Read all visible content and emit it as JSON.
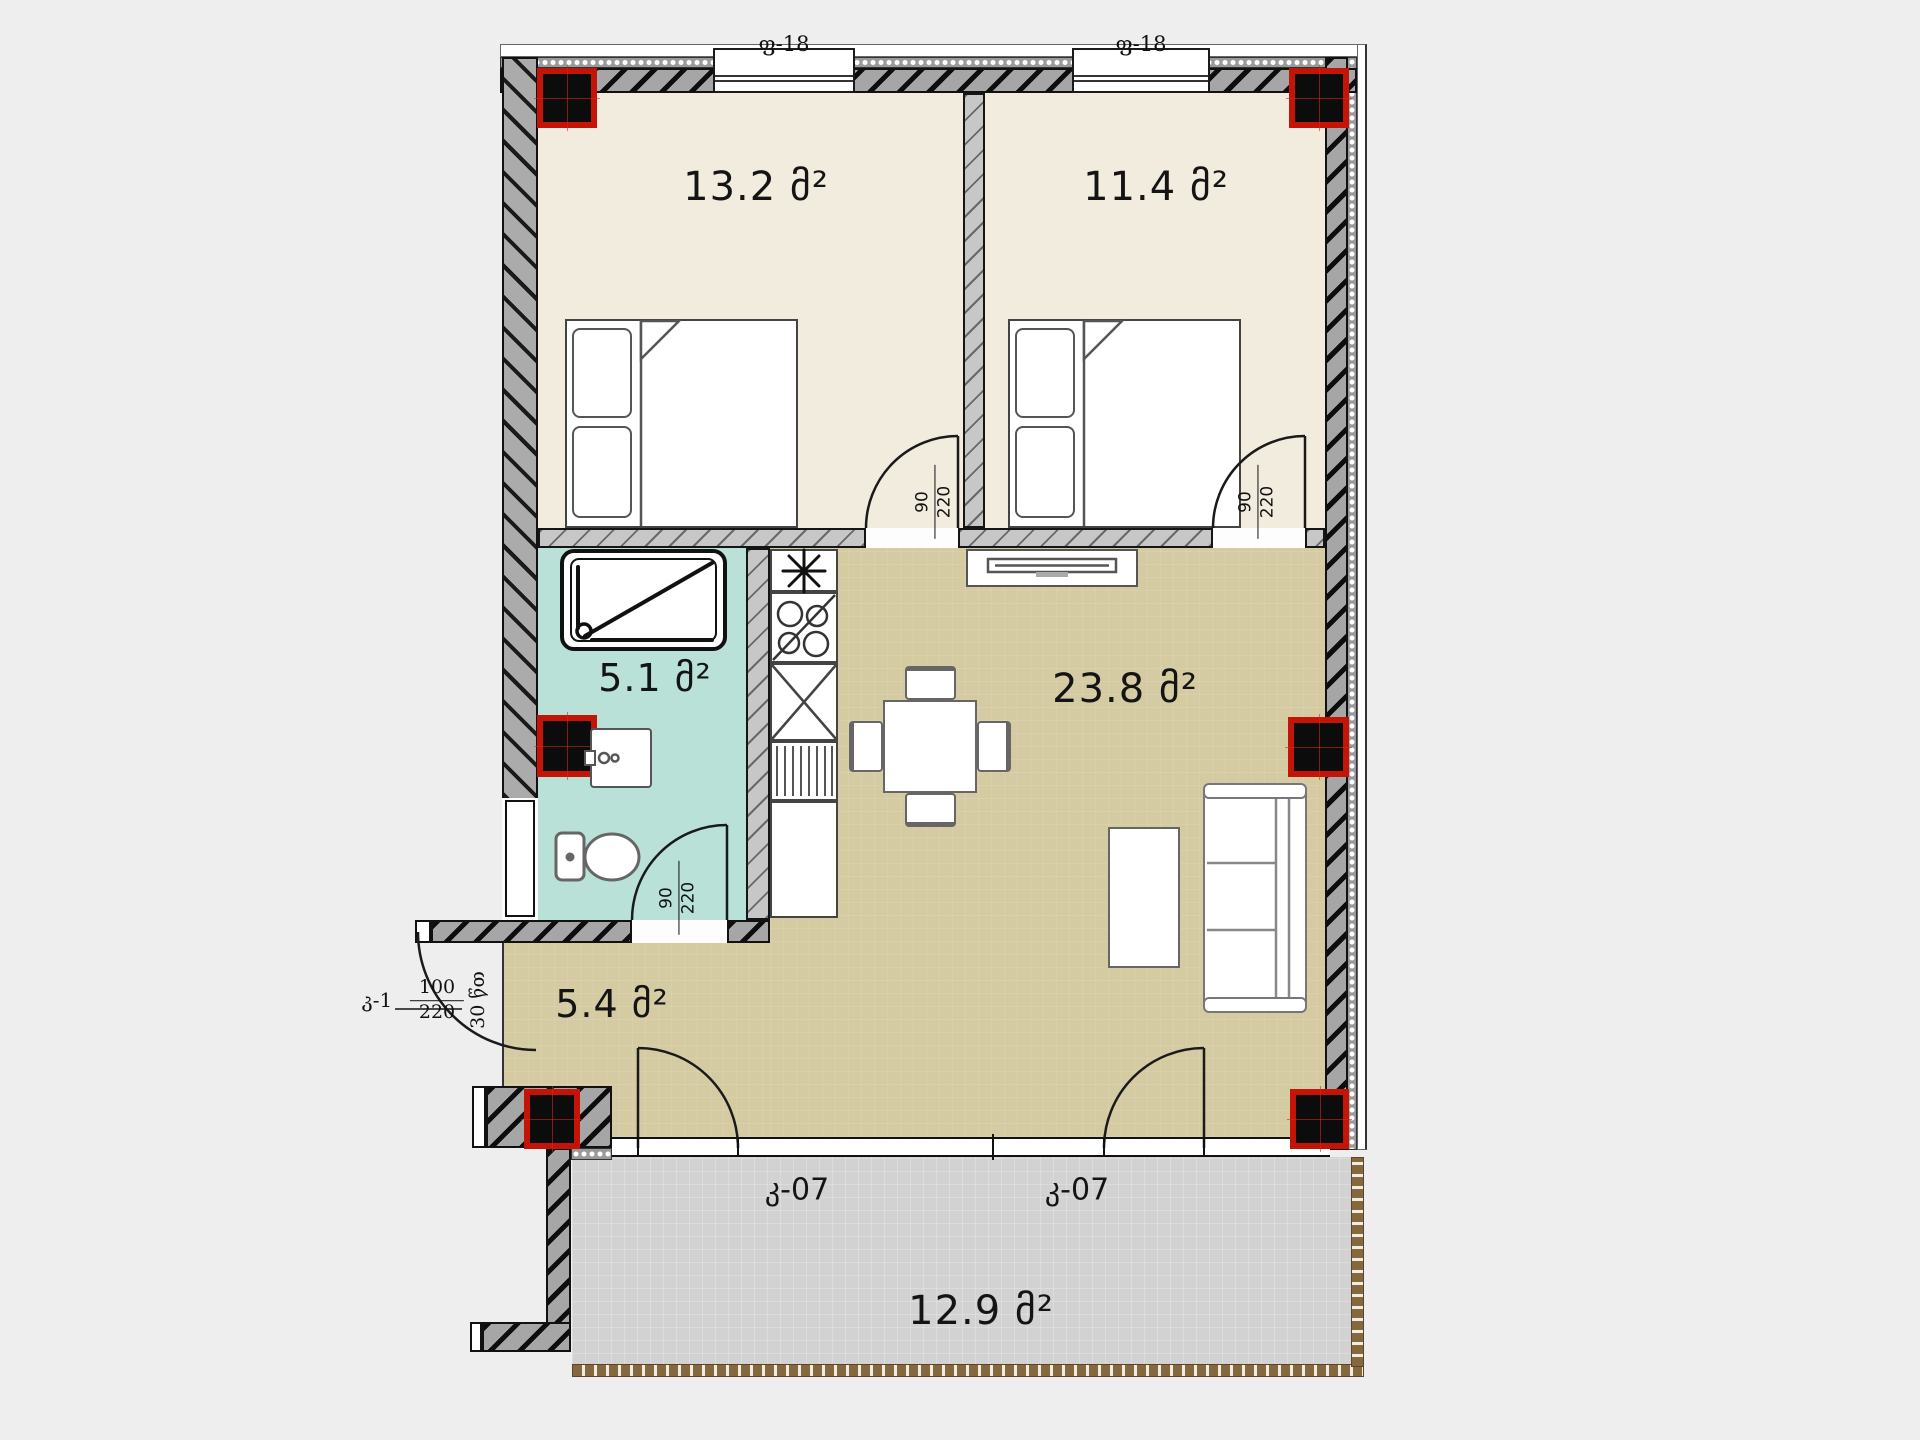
{
  "rooms": {
    "bedroom1": {
      "area": "13.2 მ²"
    },
    "bedroom2": {
      "area": "11.4 მ²"
    },
    "bathroom": {
      "area": "5.1 მ²"
    },
    "living": {
      "area": "23.8 მ²"
    },
    "hallway": {
      "area": "5.4 მ²"
    },
    "balcony": {
      "area": "12.9 მ²"
    }
  },
  "openings": {
    "window1": {
      "label": "ფ-18"
    },
    "window2": {
      "label": "ფ-18"
    },
    "balcony_door1": {
      "label": "კ-07"
    },
    "balcony_door2": {
      "label": "კ-07"
    },
    "door_bedroom1": {
      "width": "90",
      "height": "220"
    },
    "door_bedroom2": {
      "width": "90",
      "height": "220"
    },
    "door_bathroom": {
      "width": "90",
      "height": "220"
    },
    "entrance": {
      "label": "კ-1",
      "width": "100",
      "height": "220",
      "fire_rating": "30 წთ"
    }
  },
  "colors": {
    "bedroom_floor": "#f2ecdf",
    "living_floor": "#d5cba2",
    "bathroom_floor": "#b9e1d8",
    "balcony_floor": "#d2d2d2",
    "column_red": "#c41408",
    "railing_brown": "#86683f"
  }
}
